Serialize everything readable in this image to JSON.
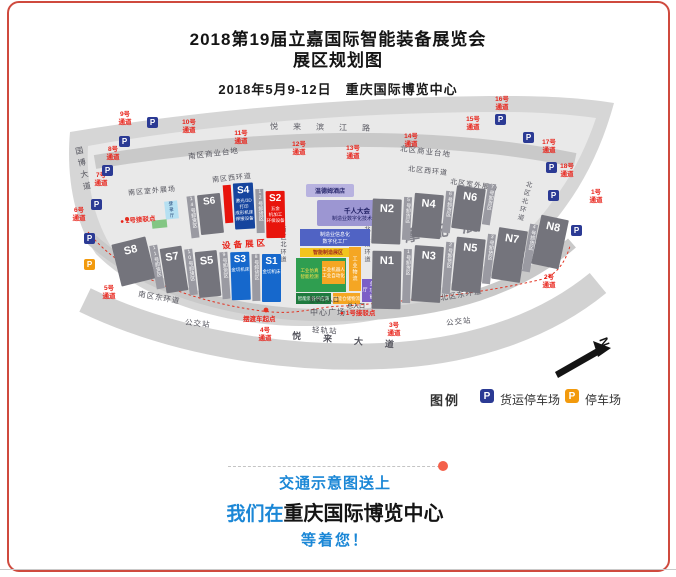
{
  "header": {
    "title_line1": "2018第19届立嘉国际智能装备展览会",
    "title_line2": "展区规划图",
    "date_venue": "2018年5月9-12日　重庆国际博览中心"
  },
  "map": {
    "halls": {
      "S1": {
        "label": "S1",
        "sub": "金切机床"
      },
      "S2": {
        "label": "S2",
        "sub": "五金\n机加工\n环保设备"
      },
      "S3": {
        "label": "S3",
        "sub": "金切机床"
      },
      "S4": {
        "label": "S4",
        "sub": "激光/3D打印\n成形机床\n焊接设备"
      },
      "S5": {
        "label": "S5"
      },
      "S6": {
        "label": "S6"
      },
      "S7": {
        "label": "S7"
      },
      "S8": {
        "label": "S8"
      },
      "N1": {
        "label": "N1"
      },
      "N2": {
        "label": "N2"
      },
      "N3": {
        "label": "N3"
      },
      "N4": {
        "label": "N4"
      },
      "N5": {
        "label": "N5"
      },
      "N6": {
        "label": "N6"
      },
      "N7": {
        "label": "N7"
      },
      "N8": {
        "label": "N8"
      }
    },
    "unloading": {
      "u1": "1号卸货区",
      "u2": "2号卸货区",
      "u3": "3号卸货区",
      "u4": "4号卸货区",
      "u5": "5号卸货区",
      "u6": "6号卸货区",
      "u7": "7号卸货区",
      "u8": "8号卸货区",
      "u9": "9号卸货区",
      "u10": "10号卸货区",
      "u11": "11号卸货区",
      "u12": "12号卸货区",
      "u14": "14号卸货区"
    },
    "gates": {
      "g1": "1号\n通道",
      "g2": "2号\n通道",
      "g3": "3号\n通道",
      "g4": "4号\n通道",
      "g5": "5号\n通道",
      "g6": "6号\n通道",
      "g7": "7号\n通道",
      "g8": "8号\n通道",
      "g9": "9号\n通道",
      "g10": "10号\n通道",
      "g11": "11号\n通道",
      "g12": "12号\n通道",
      "g13": "13号\n通道",
      "g14": "14号\n通道",
      "g15": "15号\n通道",
      "g16": "16号\n通道",
      "g17": "17号\n通道",
      "g18": "18号\n通道"
    },
    "roads": {
      "south_commercial": "南区商业台地",
      "south_west": "南区西环道",
      "south_outdoor": "南区室外展场",
      "south_east": "南区东环道",
      "south_north": "南区北环道",
      "north_commercial": "北区商业台地",
      "north_west": "北区西环道",
      "north_outdoor": "北区室外展场",
      "north_east": "北区东环道",
      "north_north": "北区北环道",
      "north_south": "北区南环道",
      "guobo": "国博大道",
      "yuelai_binjiang": "悦来滨江路",
      "yuelai": "悦来大道"
    },
    "stations": {
      "bus": "公交站",
      "rail": "轻轨站",
      "plaza": "中心广场"
    },
    "shuttle": {
      "p1": "● 1号接驳点",
      "p2": "● 2号接驳点",
      "start": "摆渡车起点"
    },
    "zones": {
      "equipment": "设备展区",
      "moto": "摩配展"
    },
    "hotel": "温德姆酒店",
    "forum": {
      "line1": "千人大会",
      "line2": "制造业数字化技术论坛"
    },
    "central": {
      "bar1": "制造业信息化",
      "bar2": "数字化工厂",
      "band": "智能制造展区",
      "box1": "工业仿真\n智能检测",
      "box2": "工业机器人\n工业自动化",
      "strip_right": "工业物流",
      "strip_green": "智能装备供应商",
      "strip_orange": "智能仓储物流",
      "hall_small": "多功能厅",
      "entrance_hall": "登录厅入口",
      "entrance_main": "总入口"
    },
    "south_entrance_hall": "登录厅",
    "compass": "N",
    "legend": {
      "title": "图例",
      "p": "P",
      "freight": "货运停车场",
      "parking": "停车场"
    }
  },
  "footer": {
    "line1": "交通示意图送上",
    "line2_blue": "我们在",
    "line2_black": "重庆国际博览中心",
    "line3": "等着您！"
  }
}
